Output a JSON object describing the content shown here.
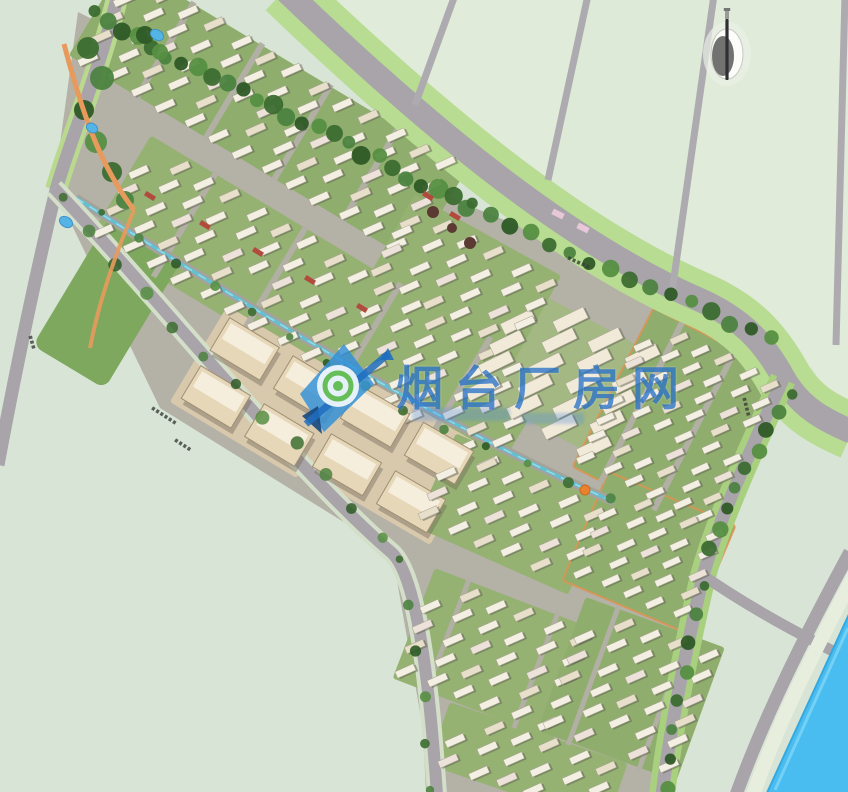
{
  "image": {
    "kind": "aerial-master-plan-rendering"
  },
  "watermark": {
    "brand_text": "烟台厂房网",
    "logo": "kite-compass-logo",
    "color": "#2b74c9"
  },
  "compass": {
    "type": "north-arrow"
  },
  "colors": {
    "background": "#d8e5d6",
    "field": "#e0ebda",
    "field_alt": "#dcе9d6",
    "underlay": "#b4b1a7",
    "road": "#a8a4a9",
    "road_thin": "#aeabb0",
    "road_verge": "#b7dc92",
    "verge_bright": "#a9d07f",
    "pale_strip": "#e7eedd",
    "tree": "#3c6d30",
    "block_ground": "#8fae6d",
    "building": "#f3efe2",
    "building_tan": "#e6d7b9",
    "building_cream": "#f1ead8",
    "tan_ground": "#d8c9ad",
    "canal": "#5fc2d5",
    "water": "#4abdf0",
    "water_edge": "#35a8e0",
    "pond": "#55b4e6",
    "accent_orange": "#e89a5c",
    "accent_red": "#b24a3e",
    "label_dark": "#3a3d38"
  }
}
